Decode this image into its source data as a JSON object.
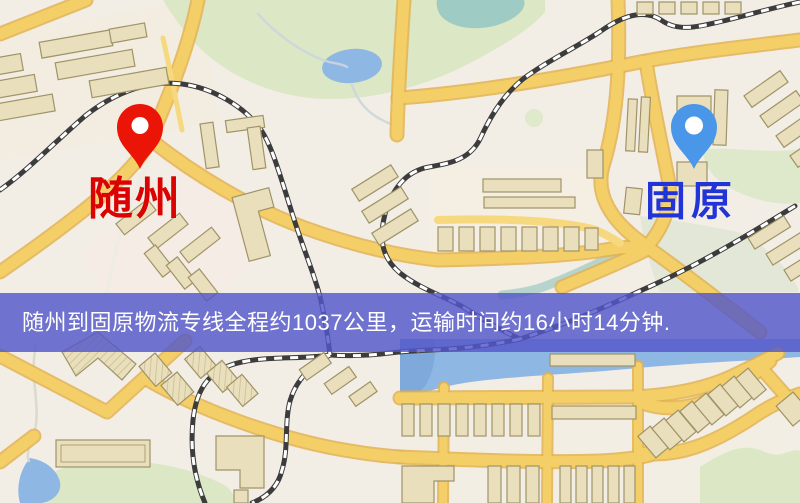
{
  "map": {
    "kind": "stylized road map",
    "features": [
      "major-roads",
      "railways",
      "buildings",
      "parks",
      "ponds",
      "river"
    ]
  },
  "origin_marker": {
    "label": "随州",
    "pin": "red-map-pin"
  },
  "destination_marker": {
    "label": "固原",
    "pin": "blue-map-pin"
  },
  "banner": {
    "text": "随州到固原物流专线全程约1037公里，运输时间约16小时14分钟."
  },
  "route_info": {
    "origin": "随州",
    "destination": "固原",
    "service": "物流专线",
    "distance_text": "约1037公里",
    "duration_text": "约16小时14分钟",
    "distance_km": 1037,
    "duration_hours": 16,
    "duration_minutes": 14
  },
  "colors": {
    "map_bg": "#f2eee6",
    "green": "#dbe7c5",
    "water": "#8fb7e3",
    "pond_teal": "#9ecbc4",
    "road": "#f4cf67",
    "road_casing": "#e3b150",
    "road_minor": "#f6d87e",
    "building": "#e9dfbc",
    "building_outline": "#a09368",
    "railway_dark": "#3c3c3c",
    "railway_light": "#ffffff",
    "origin_pin": "#ea1506",
    "origin_label": "#da0301",
    "dest_pin": "#4a96e8",
    "dest_label": "#2334d6",
    "banner_bg": "#5357c9",
    "banner_text": "#ffffff"
  }
}
